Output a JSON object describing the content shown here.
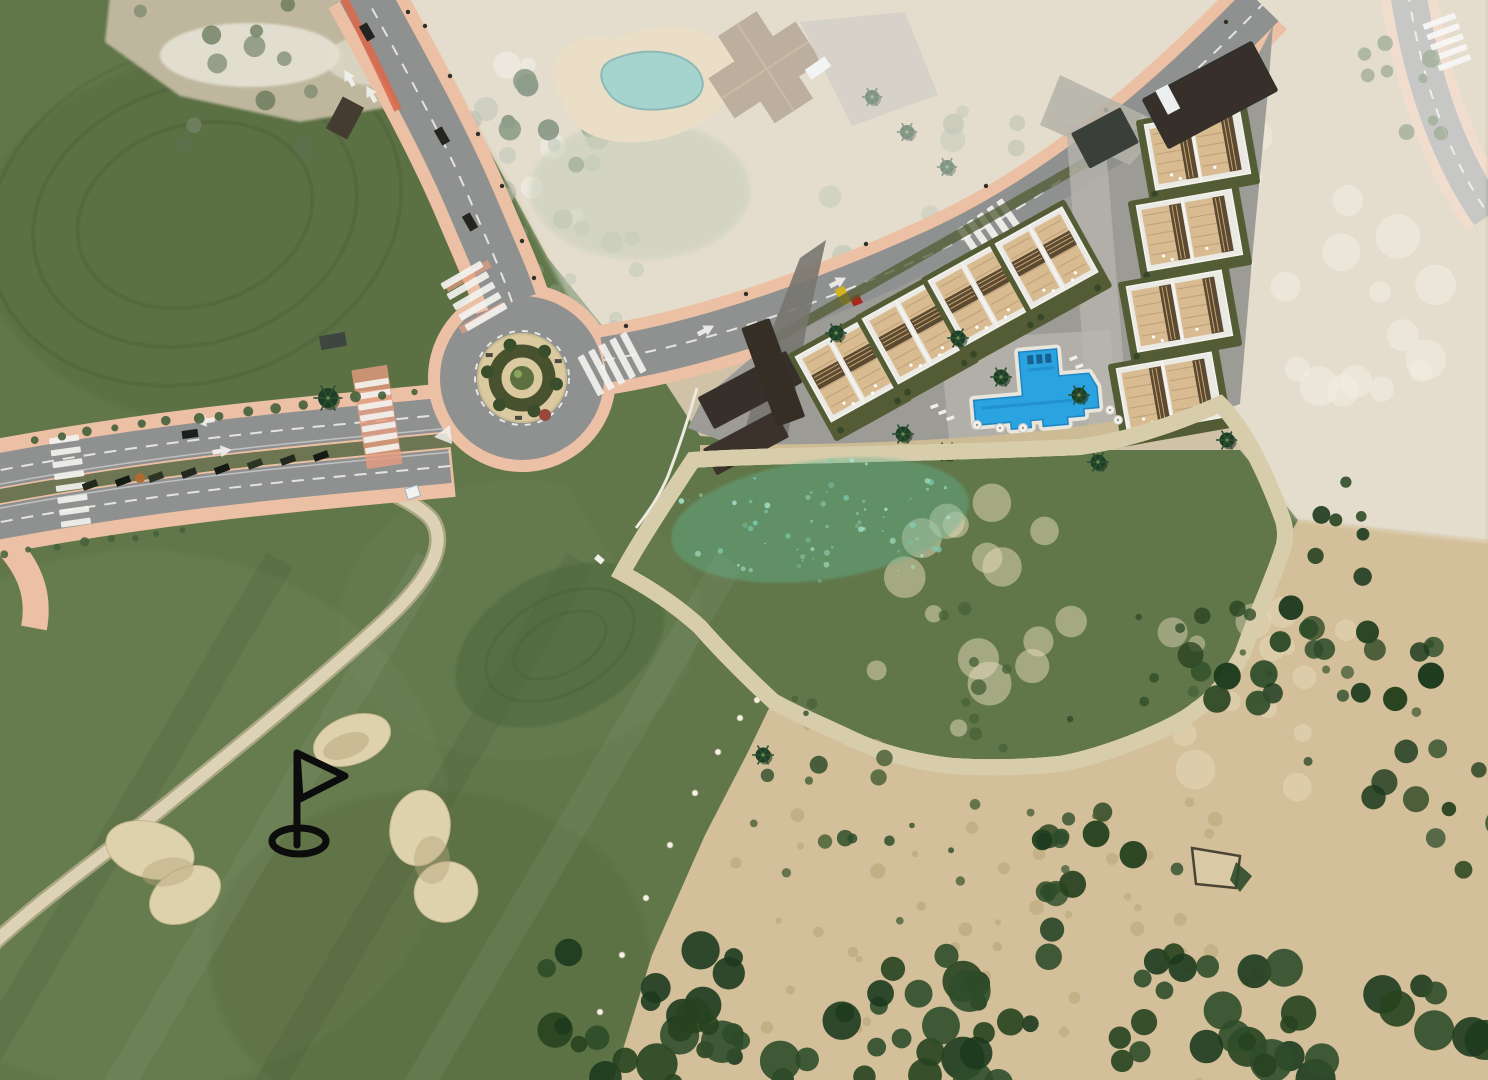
{
  "scene": {
    "type": "aerial-development-site-plan",
    "visible_text": [],
    "marker_icon": "golf-flag-icon"
  },
  "palette": {
    "grass": "#617749",
    "grass-dark": "#54693e",
    "grass-light": "#70855a",
    "green-putting": "#4d683d",
    "sand-dune": "#d3bf99",
    "sand-pale": "#cfc2a6",
    "sand-blotch": "#e8dcbc",
    "bunker-sand": "#ded2ac",
    "bunker-shade": "#b3a37a",
    "tree-dark": "#27421f",
    "tree-mid": "#2f4d2a",
    "scrub-olive": "#4a6238",
    "asphalt": "#8f9190",
    "asphalt-dark": "#77787a",
    "sidewalk-pink": "#ecc0a4",
    "apron-salmon": "#e59c80",
    "bike-red": "#d96a4d",
    "marking-white": "#f2f2ef",
    "island-tan": "#dbcaa0",
    "hedge-olive": "#49522e",
    "lake-rim": "#2b3a32",
    "lake-mid": "#3f947a",
    "lake-light": "#5fb295",
    "lake-deep": "#2c7a61",
    "algae": "#a8e3cb",
    "berm": "#d8cdaa",
    "parcel-gray": "#9d9b96",
    "court-gray": "#b4b1a8",
    "walk-gray": "#b8b5ae",
    "garden-olive": "#535c34",
    "wall-white": "#f4f3ee",
    "building-white": "#ebe9e3",
    "roof-tan": "#d9bb92",
    "deck-line": "#b99a6e",
    "pergola-dark": "#5a4a33",
    "pool-blue": "#2aa3e0",
    "pool-deep": "#1d85c3",
    "carport-dark": "#37302a",
    "villa-roof": "#8a7052",
    "villa-pool": "#5fb3a8",
    "flag-black": "#0c0c0c",
    "fade-white": "rgba(255,255,255,0.44)"
  },
  "features": {
    "golf_course": {
      "bunkers": 3,
      "cart_path": true,
      "flag_marker": true
    },
    "lake": {
      "shape": "irregular",
      "algae_speckles": true
    },
    "roundabout": {
      "arms": 3,
      "landscaped_island": true
    },
    "boulevard": {
      "carriageways": 2,
      "median_parking": true,
      "crosswalks": 2
    },
    "development": {
      "villa_blocks_row_along_road": 4,
      "villa_blocks_east_column": 4,
      "communal_pool": 1,
      "carports": true
    },
    "existing_villa": {
      "private_pool": 1,
      "faded_overlay": true
    },
    "dunes": {
      "scrub_trees": true,
      "faded_upper_area": true
    }
  }
}
